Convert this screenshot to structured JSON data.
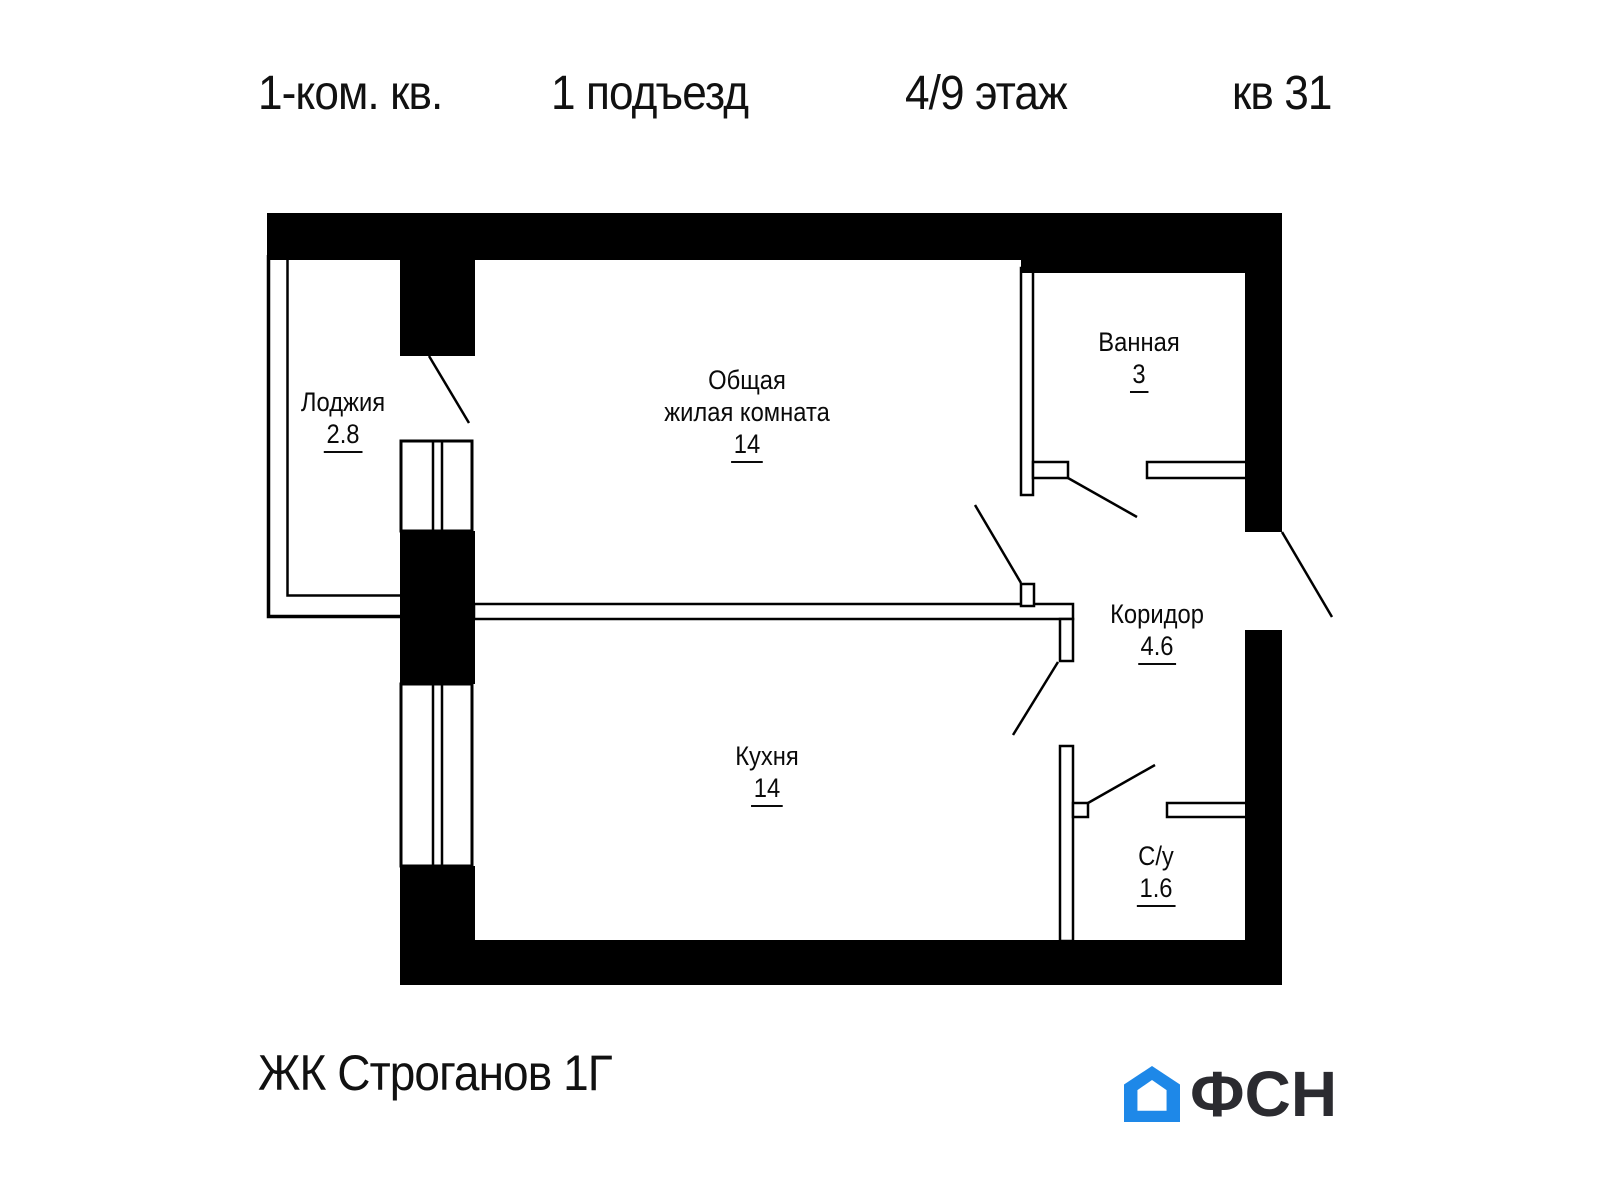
{
  "title": {
    "rooms_count": "1-ком. кв.",
    "entrance": "1 подъезд",
    "floor": "4/9 этаж",
    "apartment": "кв 31"
  },
  "rooms": {
    "loggia": {
      "name": "Лоджия",
      "area": "2.8"
    },
    "living": {
      "name_line1": "Общая",
      "name_line2": "жилая комната",
      "area": "14"
    },
    "bathroom": {
      "name": "Ванная",
      "area": "3"
    },
    "corridor": {
      "name": "Коридор",
      "area": "4.6"
    },
    "kitchen": {
      "name": "Кухня",
      "area": "14"
    },
    "wc": {
      "name": "С/у",
      "area": "1.6"
    }
  },
  "footer": {
    "complex_name": "ЖК Строганов 1Г"
  },
  "logo": {
    "text": "ФСН",
    "icon": "house-icon",
    "blue": "#1e88e8",
    "ink": "#2b2b30"
  }
}
